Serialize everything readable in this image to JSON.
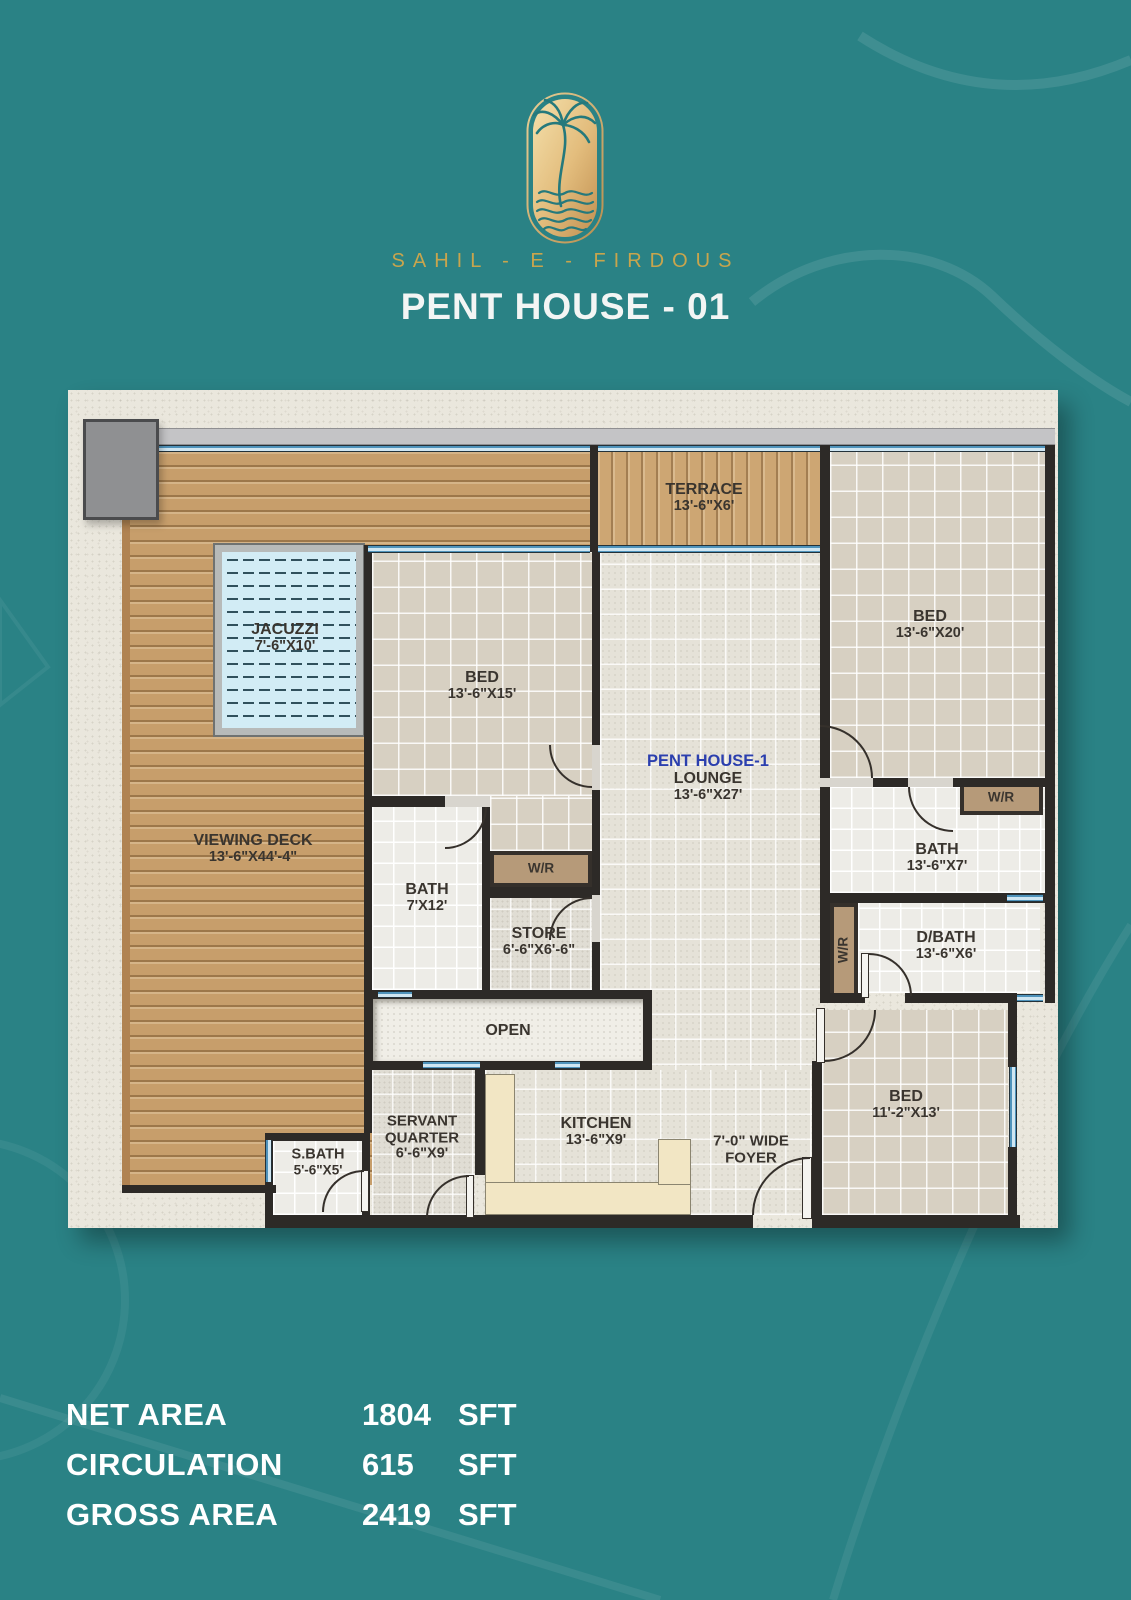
{
  "header": {
    "brand": "SAHIL - E - FIRDOUS",
    "title": "PENT HOUSE - 01",
    "logo": "palm-beach-logo"
  },
  "colors": {
    "teal_background": "#2a8285",
    "gold_accent": "#c8a54d",
    "wall": "#2d2a27",
    "wood_deck": "#c79e6b",
    "glass_window": "#7db6d2",
    "lounge_title_blue": "#2b3fae",
    "wr_brown": "#b69a79",
    "jacuzzi_water": "#d2ecf5"
  },
  "plan": {
    "labels": {
      "terrace": {
        "name": "TERRACE",
        "dims": "13'-6\"X6'"
      },
      "bed20": {
        "name": "BED",
        "dims": "13'-6\"X20'"
      },
      "jacuzzi": {
        "name": "JACUZZI",
        "dims": "7'-6\"X10'"
      },
      "bed15": {
        "name": "BED",
        "dims": "13'-6\"X15'"
      },
      "lounge": {
        "title": "PENT HOUSE-1",
        "name": "LOUNGE",
        "dims": "13'-6\"X27'"
      },
      "wr1": {
        "name": "W/R"
      },
      "viewing_deck": {
        "name": "VIEWING DECK",
        "dims": "13'-6\"X44'-4\""
      },
      "bath7": {
        "name": "BATH",
        "dims": "7'X12'"
      },
      "wr2": {
        "name": "W/R"
      },
      "bath13": {
        "name": "BATH",
        "dims": "13'-6\"X7'"
      },
      "store": {
        "name": "STORE",
        "dims": "6'-6\"X6'-6\""
      },
      "wr3": {
        "name": "W/R"
      },
      "dbath": {
        "name": "D/BATH",
        "dims": "13'-6\"X6'"
      },
      "open": {
        "name": "OPEN"
      },
      "servant": {
        "name1": "SERVANT",
        "name2": "QUARTER",
        "dims": "6'-6\"X9'"
      },
      "sbath": {
        "name": "S.BATH",
        "dims": "5'-6\"X5'"
      },
      "kitchen": {
        "name": "KITCHEN",
        "dims": "13'-6\"X9'"
      },
      "foyer": {
        "name1": "7'-0\" WIDE",
        "name2": "FOYER"
      },
      "bed11": {
        "name": "BED",
        "dims": "11'-2\"X13'"
      }
    }
  },
  "stats": {
    "rows": [
      {
        "label": "NET AREA",
        "value": "1804",
        "unit": "SFT"
      },
      {
        "label": "CIRCULATION",
        "value": "615",
        "unit": "SFT"
      },
      {
        "label": "GROSS AREA",
        "value": "2419",
        "unit": "SFT"
      }
    ]
  }
}
